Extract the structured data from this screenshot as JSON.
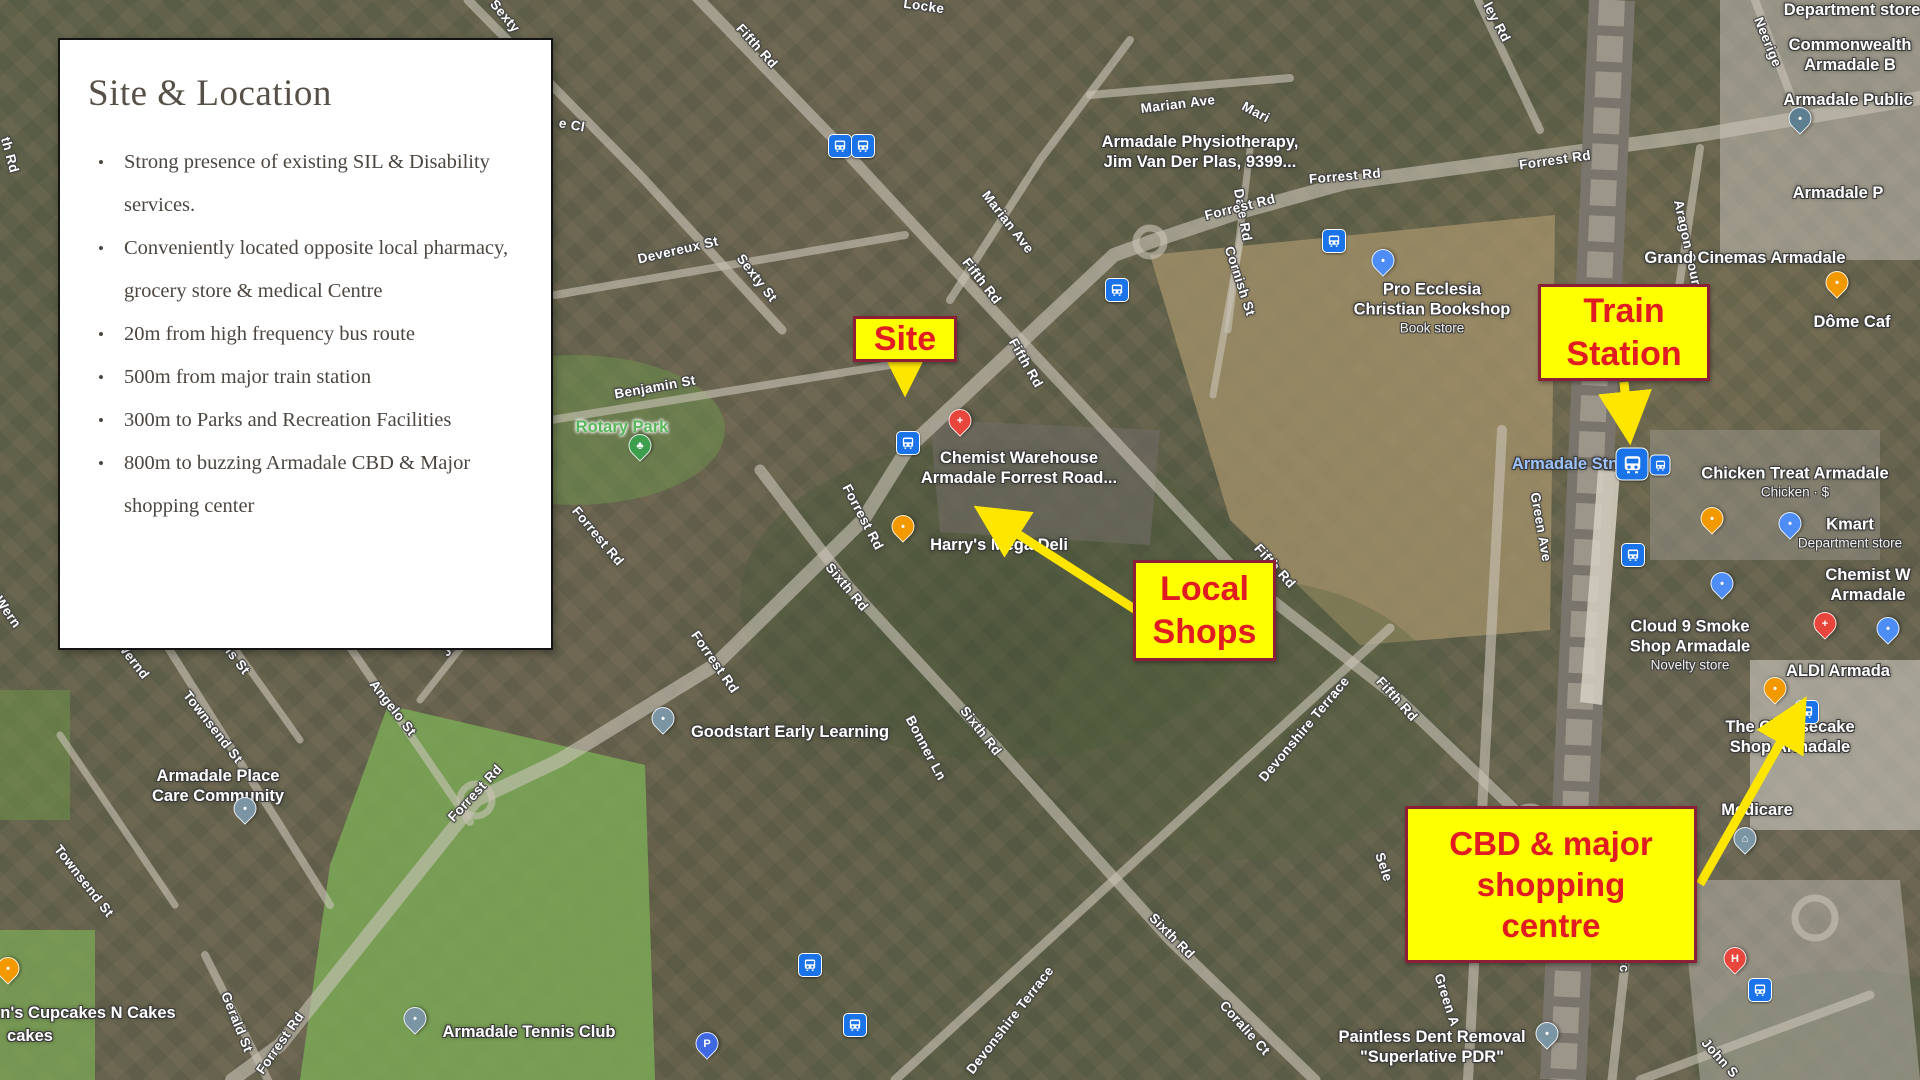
{
  "info_box": {
    "title": "Site & Location",
    "bullets": [
      "Strong presence of existing SIL & Disability services.",
      "Conveniently located opposite local pharmacy, grocery store & medical Centre",
      "20m from high frequency bus route",
      "500m from major train station",
      "300m to Parks and Recreation Facilities",
      "800m to buzzing Armadale CBD & Major shopping center"
    ]
  },
  "callouts": {
    "site": {
      "label": "Site"
    },
    "local_shops": {
      "lines": [
        "Local",
        "Shops"
      ]
    },
    "train_station": {
      "lines": [
        "Train",
        "Station"
      ]
    },
    "cbd": {
      "lines": [
        "CBD & major",
        "shopping",
        "centre"
      ]
    }
  },
  "colors": {
    "callout_bg": "#feff00",
    "callout_border": "#8a2038",
    "callout_text": "#e11b22",
    "arrow": "#ffe600",
    "transit_blue": "#1a73e8",
    "station_text_blue": "#9dc2f9",
    "park_green": "#58b65c"
  },
  "map": {
    "street_labels": [
      {
        "text": "Sexty",
        "x": 505,
        "y": 16,
        "rot": 50
      },
      {
        "text": "Fifth Rd",
        "x": 757,
        "y": 46,
        "rot": 48
      },
      {
        "text": "e Cl",
        "x": 572,
        "y": 125,
        "rot": 10
      },
      {
        "text": "Locke",
        "x": 924,
        "y": 6,
        "rot": 8
      },
      {
        "text": "Marian Ave",
        "x": 1178,
        "y": 104,
        "rot": -7
      },
      {
        "text": "Mari",
        "x": 1256,
        "y": 112,
        "rot": 28
      },
      {
        "text": "Marian Ave",
        "x": 1008,
        "y": 222,
        "rot": 52
      },
      {
        "text": "Dale Rd",
        "x": 1243,
        "y": 215,
        "rot": 80
      },
      {
        "text": "Fifth Rd",
        "x": 982,
        "y": 281,
        "rot": 52
      },
      {
        "text": "Fifth Rd",
        "x": 1026,
        "y": 363,
        "rot": 60
      },
      {
        "text": "Forrest Rd",
        "x": 1240,
        "y": 207,
        "rot": -14
      },
      {
        "text": "Forrest Rd",
        "x": 1345,
        "y": 176,
        "rot": -5
      },
      {
        "text": "Cornish St",
        "x": 1240,
        "y": 281,
        "rot": 72
      },
      {
        "text": "Devereux St",
        "x": 678,
        "y": 250,
        "rot": -13
      },
      {
        "text": "Sexty St",
        "x": 757,
        "y": 278,
        "rot": 52
      },
      {
        "text": "Benjamin St",
        "x": 655,
        "y": 387,
        "rot": -10
      },
      {
        "text": "ley Rd",
        "x": 1497,
        "y": 22,
        "rot": 62
      },
      {
        "text": "Neerige",
        "x": 1768,
        "y": 42,
        "rot": 68
      },
      {
        "text": "Aragon Court",
        "x": 1688,
        "y": 245,
        "rot": 78
      },
      {
        "text": "Forrest Rd",
        "x": 1555,
        "y": 160,
        "rot": -8
      },
      {
        "text": "Forrest Rd",
        "x": 598,
        "y": 536,
        "rot": 50
      },
      {
        "text": "Forrest Rd",
        "x": 863,
        "y": 517,
        "rot": 62
      },
      {
        "text": "Forrest Rd",
        "x": 715,
        "y": 662,
        "rot": 55
      },
      {
        "text": "Forrest Rd",
        "x": 475,
        "y": 793,
        "rot": -47
      },
      {
        "text": "Forrest Rd",
        "x": 280,
        "y": 1043,
        "rot": -55
      },
      {
        "text": "th Rd",
        "x": 10,
        "y": 155,
        "rot": 75
      },
      {
        "text": "Wern",
        "x": 8,
        "y": 612,
        "rot": 55
      },
      {
        "text": "Wernd",
        "x": 133,
        "y": 660,
        "rot": 52
      },
      {
        "text": "alis St",
        "x": 234,
        "y": 656,
        "rot": 52
      },
      {
        "text": "Townsend St",
        "x": 213,
        "y": 727,
        "rot": 52
      },
      {
        "text": "Townsend St",
        "x": 84,
        "y": 881,
        "rot": 52
      },
      {
        "text": "Angelo St",
        "x": 393,
        "y": 708,
        "rot": 52
      },
      {
        "text": "Jan",
        "x": 452,
        "y": 645,
        "rot": -50
      },
      {
        "text": "s St",
        "x": 478,
        "y": 617,
        "rot": -50
      },
      {
        "text": "Gerald St",
        "x": 237,
        "y": 1022,
        "rot": 68
      },
      {
        "text": "Sixth Rd",
        "x": 847,
        "y": 587,
        "rot": 50
      },
      {
        "text": "Sixth Rd",
        "x": 981,
        "y": 731,
        "rot": 52
      },
      {
        "text": "Sixth Rd",
        "x": 1172,
        "y": 936,
        "rot": 45
      },
      {
        "text": "Bonner Ln",
        "x": 926,
        "y": 748,
        "rot": 62
      },
      {
        "text": "Devonshire Terrace",
        "x": 1304,
        "y": 729,
        "rot": -50
      },
      {
        "text": "Devonshire Terrace",
        "x": 1010,
        "y": 1020,
        "rot": -52
      },
      {
        "text": "Fifth Rd",
        "x": 1275,
        "y": 566,
        "rot": 48
      },
      {
        "text": "Fifth Rd",
        "x": 1397,
        "y": 699,
        "rot": 48
      },
      {
        "text": "Coralie Ct",
        "x": 1245,
        "y": 1028,
        "rot": 48
      },
      {
        "text": "Sele",
        "x": 1384,
        "y": 867,
        "rot": 72
      },
      {
        "text": "Green Ave",
        "x": 1541,
        "y": 527,
        "rot": 80
      },
      {
        "text": "Green A",
        "x": 1447,
        "y": 1000,
        "rot": 72
      },
      {
        "text": "Commerc",
        "x": 1622,
        "y": 940,
        "rot": 85
      },
      {
        "text": "John S",
        "x": 1720,
        "y": 1058,
        "rot": 48
      }
    ],
    "place_labels": [
      {
        "lines": [
          "Armadale Physiotherapy,",
          "Jim Van Der Plas, 9399..."
        ],
        "x": 1200,
        "y": 152
      },
      {
        "lines": [
          "Pro Ecclesia",
          "Christian Bookshop"
        ],
        "sub": [
          "Book store"
        ],
        "x": 1432,
        "y": 308
      },
      {
        "lines": [
          "Chemist Warehouse",
          "Armadale Forrest Road..."
        ],
        "x": 1019,
        "y": 468
      },
      {
        "lines": [
          "Harry's Mega Deli"
        ],
        "x": 999,
        "y": 545
      },
      {
        "lines": [
          "Grand Cinemas Armadale"
        ],
        "x": 1745,
        "y": 258
      },
      {
        "lines": [
          "Armadale Stn"
        ],
        "x": 1565,
        "y": 464,
        "color": "blue"
      },
      {
        "lines": [
          "Chicken Treat Armadale"
        ],
        "sub": [
          "Chicken · $"
        ],
        "x": 1795,
        "y": 482
      },
      {
        "lines": [
          "Kmart"
        ],
        "sub": [
          "Department store"
        ],
        "x": 1850,
        "y": 533
      },
      {
        "lines": [
          "Chemist W",
          "Armadale"
        ],
        "x": 1868,
        "y": 585
      },
      {
        "lines": [
          "ALDI Armada"
        ],
        "x": 1838,
        "y": 671
      },
      {
        "lines": [
          "Cloud 9 Smoke",
          "Shop Armadale"
        ],
        "sub": [
          "Novelty store"
        ],
        "x": 1690,
        "y": 645
      },
      {
        "lines": [
          "The Cheesecake",
          "Shop Armadale"
        ],
        "x": 1790,
        "y": 737
      },
      {
        "lines": [
          "Medicare"
        ],
        "x": 1757,
        "y": 810
      },
      {
        "lines": [
          "Paintless Dent Removal",
          "\"Superlative PDR\""
        ],
        "x": 1432,
        "y": 1047
      },
      {
        "lines": [
          "Armadale Tennis Club"
        ],
        "x": 529,
        "y": 1032
      },
      {
        "lines": [
          "Goodstart Early Learning"
        ],
        "x": 790,
        "y": 732
      },
      {
        "lines": [
          "Armadale Place",
          "Care Community"
        ],
        "x": 218,
        "y": 786
      },
      {
        "lines": [
          "n's Cupcakes N Cakes"
        ],
        "x": 88,
        "y": 1013
      },
      {
        "lines": [
          "cakes"
        ],
        "x": 30,
        "y": 1036
      },
      {
        "lines": [
          "Commonwealth",
          "Armadale B"
        ],
        "x": 1850,
        "y": 55
      },
      {
        "lines": [
          "Armadale Public"
        ],
        "x": 1848,
        "y": 100
      },
      {
        "lines": [
          "Department store"
        ],
        "x": 1852,
        "y": 10
      },
      {
        "lines": [
          "Armadale P"
        ],
        "x": 1838,
        "y": 193
      },
      {
        "lines": [
          "Dôme Caf"
        ],
        "x": 1852,
        "y": 322
      },
      {
        "lines": [
          "Rotary Park"
        ],
        "x": 622,
        "y": 427,
        "color": "green"
      }
    ],
    "transit_icons": [
      {
        "kind": "bus",
        "x": 840,
        "y": 146
      },
      {
        "kind": "bus",
        "x": 863,
        "y": 146
      },
      {
        "kind": "bus",
        "x": 1117,
        "y": 290
      },
      {
        "kind": "bus",
        "x": 1334,
        "y": 241
      },
      {
        "kind": "bus",
        "x": 908,
        "y": 443
      },
      {
        "kind": "train",
        "x": 1632,
        "y": 464
      },
      {
        "kind": "bus-sm",
        "x": 1660,
        "y": 465
      },
      {
        "kind": "bus",
        "x": 1633,
        "y": 555
      },
      {
        "kind": "bus",
        "x": 1807,
        "y": 712
      },
      {
        "kind": "bus",
        "x": 810,
        "y": 965
      },
      {
        "kind": "bus",
        "x": 855,
        "y": 1025
      },
      {
        "kind": "bus",
        "x": 1760,
        "y": 990
      }
    ],
    "pins": [
      {
        "kind": "chemist",
        "x": 960,
        "y": 432
      },
      {
        "kind": "food",
        "x": 903,
        "y": 538
      },
      {
        "kind": "generic",
        "x": 663,
        "y": 730
      },
      {
        "kind": "generic",
        "x": 245,
        "y": 820
      },
      {
        "kind": "food",
        "x": 8,
        "y": 980
      },
      {
        "kind": "generic",
        "x": 415,
        "y": 1030
      },
      {
        "kind": "generic",
        "x": 1547,
        "y": 1045
      },
      {
        "kind": "shopping",
        "x": 1383,
        "y": 272
      },
      {
        "kind": "library",
        "x": 1800,
        "y": 130
      },
      {
        "kind": "coffee",
        "x": 1837,
        "y": 294
      },
      {
        "kind": "food",
        "x": 1712,
        "y": 530
      },
      {
        "kind": "shopping",
        "x": 1790,
        "y": 535
      },
      {
        "kind": "shopping",
        "x": 1722,
        "y": 595
      },
      {
        "kind": "chemist",
        "x": 1825,
        "y": 635
      },
      {
        "kind": "cart",
        "x": 1888,
        "y": 640
      },
      {
        "kind": "food",
        "x": 1775,
        "y": 700
      },
      {
        "kind": "bank",
        "x": 1745,
        "y": 850
      },
      {
        "kind": "hospital",
        "x": 1735,
        "y": 970
      },
      {
        "kind": "parking",
        "x": 707,
        "y": 1055
      },
      {
        "kind": "park",
        "x": 640,
        "y": 457
      }
    ]
  }
}
